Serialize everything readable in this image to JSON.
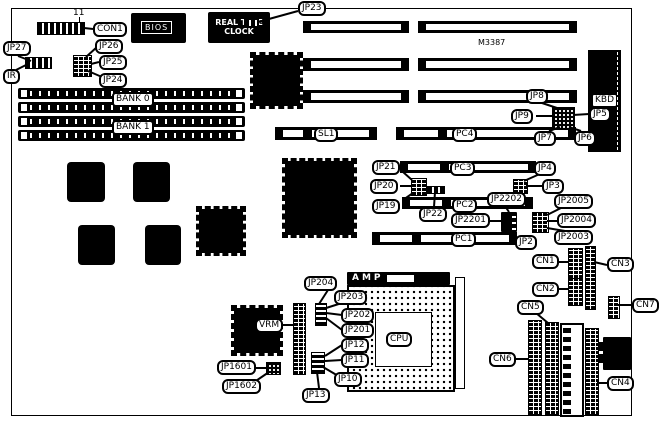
{
  "chips": {
    "bios": "BIOS",
    "rtc_line1": "REAL TIME",
    "rtc_line2": "CLOCK",
    "m3387": "M3387",
    "amp": "AMP",
    "cpu": "CPU",
    "kbd": "KBD",
    "pin11": "11"
  },
  "labels": {
    "con1": "CON1",
    "jp26": "JP26",
    "jp25": "JP25",
    "jp24": "JP24",
    "jp27": "JP27",
    "ir": "IR",
    "jp23": "JP23",
    "bank0": "BANK 0",
    "bank1": "BANK 1",
    "jp8": "JP8",
    "jp9": "JP9",
    "jp5": "JP5",
    "jp7": "JP7",
    "jp6": "JP6",
    "sl1": "SL1",
    "pc4": "PC4",
    "pc3": "PC3",
    "pc2": "PC2",
    "pc1": "PC1",
    "jp21": "JP21",
    "jp20": "JP20",
    "jp19": "JP19",
    "jp22": "JP22",
    "jp4": "JP4",
    "jp3": "JP3",
    "jp2202": "JP2202",
    "jp2201": "JP2201",
    "jp2005": "JP2005",
    "jp2004": "JP2004",
    "jp2003": "JP2003",
    "jp2": "JP2",
    "cn1": "CN1",
    "cn2": "CN2",
    "cn3": "CN3",
    "cn4": "CN4",
    "cn5": "CN5",
    "cn6": "CN6",
    "cn7": "CN7",
    "jp204": "JP204",
    "jp203": "JP203",
    "jp202": "JP202",
    "jp201": "JP201",
    "jp12": "JP12",
    "jp11": "JP11",
    "jp10": "JP10",
    "jp13": "JP13",
    "vrm": "VRM",
    "jp1601": "JP1601",
    "jp1602": "JP1602"
  },
  "colors": {
    "ink": "#000000",
    "paper": "#ffffff"
  }
}
